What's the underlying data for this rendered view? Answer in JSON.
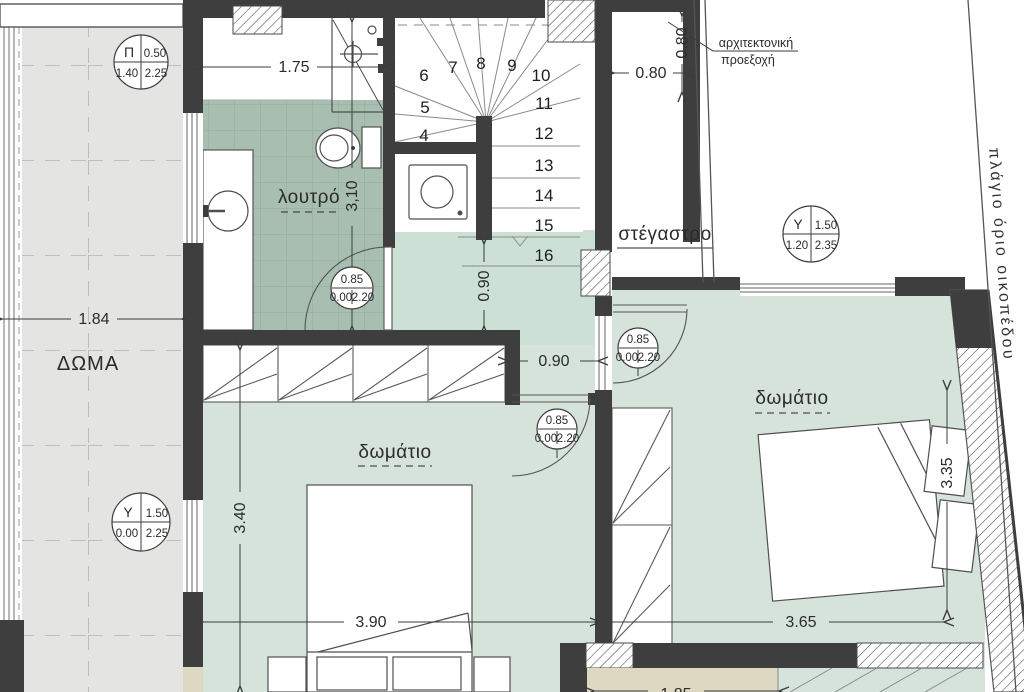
{
  "sheet": {
    "background": "#ffffff"
  },
  "colors": {
    "wall": "#3e3e3e",
    "bath_tile": "#a8beb0",
    "floor_green": "#d6e3db",
    "hall_green": "#cde0d5",
    "terrace_gray": "#e4e4e2",
    "beige": "#dcd8c1"
  },
  "rooms": {
    "terrace": "ΔΩΜΑ",
    "bathroom": "λουτρό",
    "bedroom_left": "δωμάτιο",
    "bedroom_right": "δωμάτιο",
    "canopy": "στέγαστρο"
  },
  "annotations": {
    "projection_line1": "αρχιτεκτονική",
    "projection_line2": "προεξοχή",
    "site_boundary": "πλάγιο όριο οικοπέδου"
  },
  "dimensions": {
    "bath_width": "1.75",
    "bath_length": "3,10",
    "terrace_width": "1.84",
    "niche_width": "0.80",
    "niche_depth": "0.80",
    "hall_width_v": "0.90",
    "hall_width_h": "0.90",
    "bedroom_left_depth": "3.40",
    "bedroom_left_width": "3.90",
    "bedroom_right_width": "3.65",
    "bedroom_right_depth": "3.35",
    "bottom_partial": "1.85"
  },
  "stairs": [
    "4",
    "5",
    "6",
    "7",
    "8",
    "9",
    "10",
    "11",
    "12",
    "13",
    "14",
    "15",
    "16"
  ],
  "tags": {
    "window_pi": {
      "letter": "Π",
      "top_right": "0.50",
      "bottom_left": "1.40",
      "bottom_right": "2.25"
    },
    "window_y_canopy": {
      "letter": "Y",
      "top_right": "1.50",
      "bottom_left": "1.20",
      "bottom_right": "2.35"
    },
    "window_y_terrace": {
      "letter": "Y",
      "top_right": "1.50",
      "bottom_left": "0.00",
      "bottom_right": "2.25"
    },
    "door": {
      "top": "0.85",
      "bottom_left": "0.00",
      "bottom_right": "2.20"
    }
  }
}
